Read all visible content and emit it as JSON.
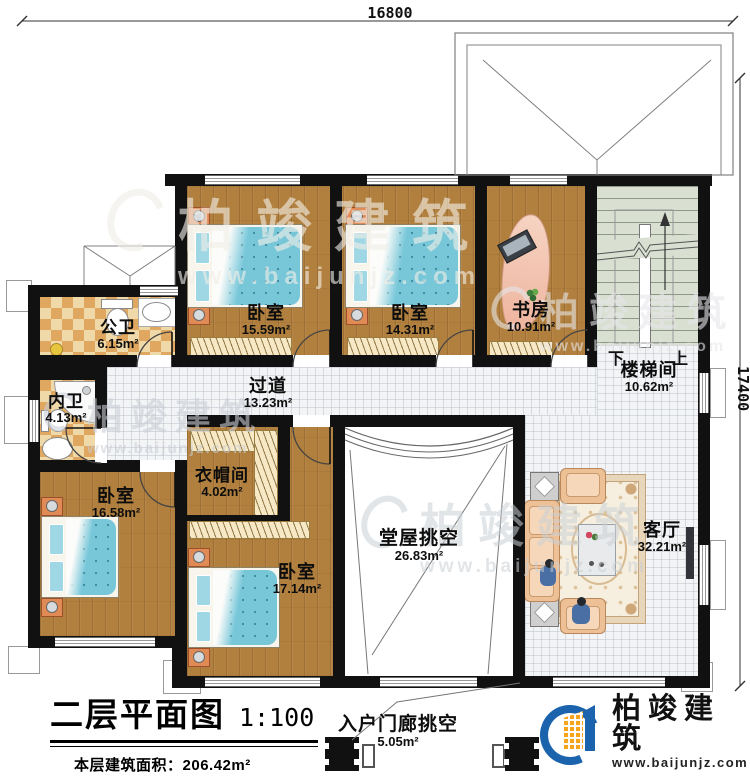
{
  "dims": {
    "top": "16800",
    "right": "17400"
  },
  "rooms": {
    "bedroom1": {
      "name": "卧室",
      "area": "15.59m²"
    },
    "bedroom2": {
      "name": "卧室",
      "area": "14.31m²"
    },
    "study": {
      "name": "书房",
      "area": "10.91m²"
    },
    "stairwell": {
      "name": "楼梯间",
      "area": "10.62m²",
      "down": "下",
      "up": "上"
    },
    "public_bath": {
      "name": "公卫",
      "area": "6.15m²"
    },
    "corridor": {
      "name": "过道",
      "area": "13.23m²"
    },
    "private_bath": {
      "name": "内卫",
      "area": "4.13m²"
    },
    "bedroom3": {
      "name": "卧室",
      "area": "16.58m²"
    },
    "cloakroom": {
      "name": "衣帽间",
      "area": "4.02m²"
    },
    "bedroom4": {
      "name": "卧室",
      "area": "17.14m²"
    },
    "hall_void": {
      "name": "堂屋挑空",
      "area": "26.83m²"
    },
    "living_room": {
      "name": "客厅",
      "area": "32.21m²"
    },
    "porch_void": {
      "name": "入户门廊挑空",
      "area": "5.05m²"
    }
  },
  "titleblock": {
    "title": "二层平面图",
    "scale": "1:100",
    "area_label": "本层建筑面积：",
    "area_value": "206.42m²",
    "height_label": "层高：",
    "height_value": "3.3m"
  },
  "watermark": {
    "brand": "柏竣建筑",
    "url": "www.baijunjz.com"
  },
  "logo": {
    "brand": "柏竣建筑",
    "url": "www.baijunjz.com"
  },
  "colors": {
    "wall": "#111111",
    "wood": "#b2803e",
    "bed_teal": "#77c7d9",
    "tile_light": "#f0d9a8",
    "tile_dark": "#dfa75f",
    "stair_green": "#d9dfd1",
    "logo_blue": "#1b63ac",
    "logo_orange": "#f7a41d"
  }
}
